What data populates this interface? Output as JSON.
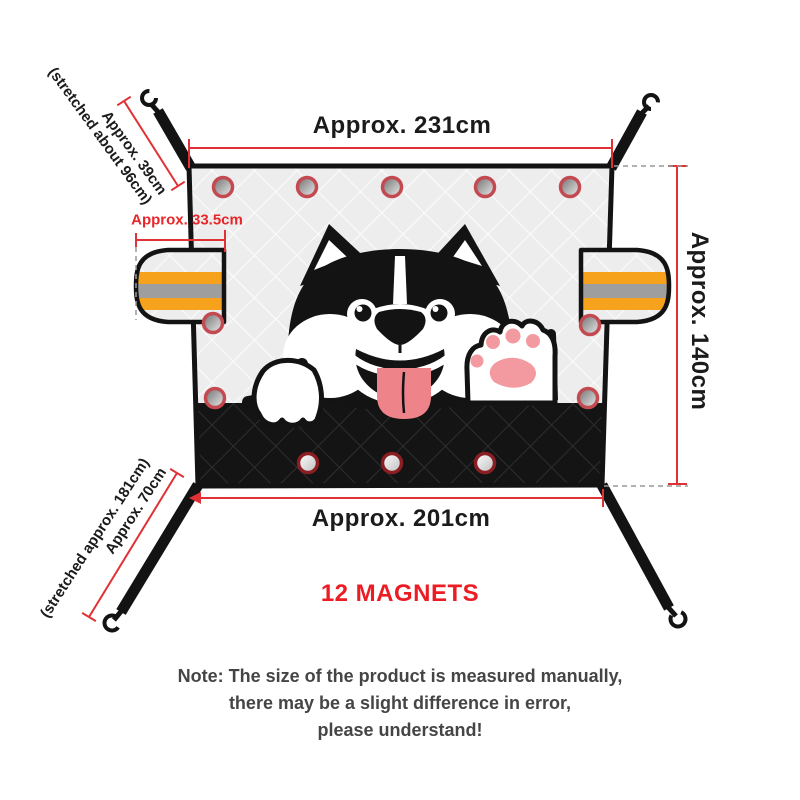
{
  "product": {
    "dimensions": {
      "top_width": "Approx. 231cm",
      "right_height": "Approx. 140cm",
      "bottom_width": "Approx. 201cm",
      "side_flap_width": "Approx. 33.5cm",
      "top_strap_length": "Approx. 39cm",
      "top_strap_stretched": "(stretched about 96cm)",
      "bottom_strap_length": "Approx. 70cm",
      "bottom_strap_stretched": "(stretched approx. 181cm)"
    },
    "magnets": {
      "label": "12 MAGNETS",
      "count": 12
    },
    "note": {
      "line1": "Note: The size of the product is measured manually,",
      "line2": "there may be a slight difference in error,",
      "line3": "please understand!"
    },
    "colors": {
      "dimension_red": "#e03236",
      "label_red": "#e8262a",
      "magnets_red": "#ec1c24",
      "stripe_orange": "#f7a21c",
      "stripe_gray": "#9e9e9e",
      "fabric_light": "#ededed",
      "fabric_dark": "#141414",
      "outline_black": "#131313",
      "tongue_pink": "#ef838a",
      "paw_pad_pink": "#f29aa0",
      "magnet_ring_light": "#c24a50",
      "magnet_ring_dark": "#8a1e22"
    }
  }
}
